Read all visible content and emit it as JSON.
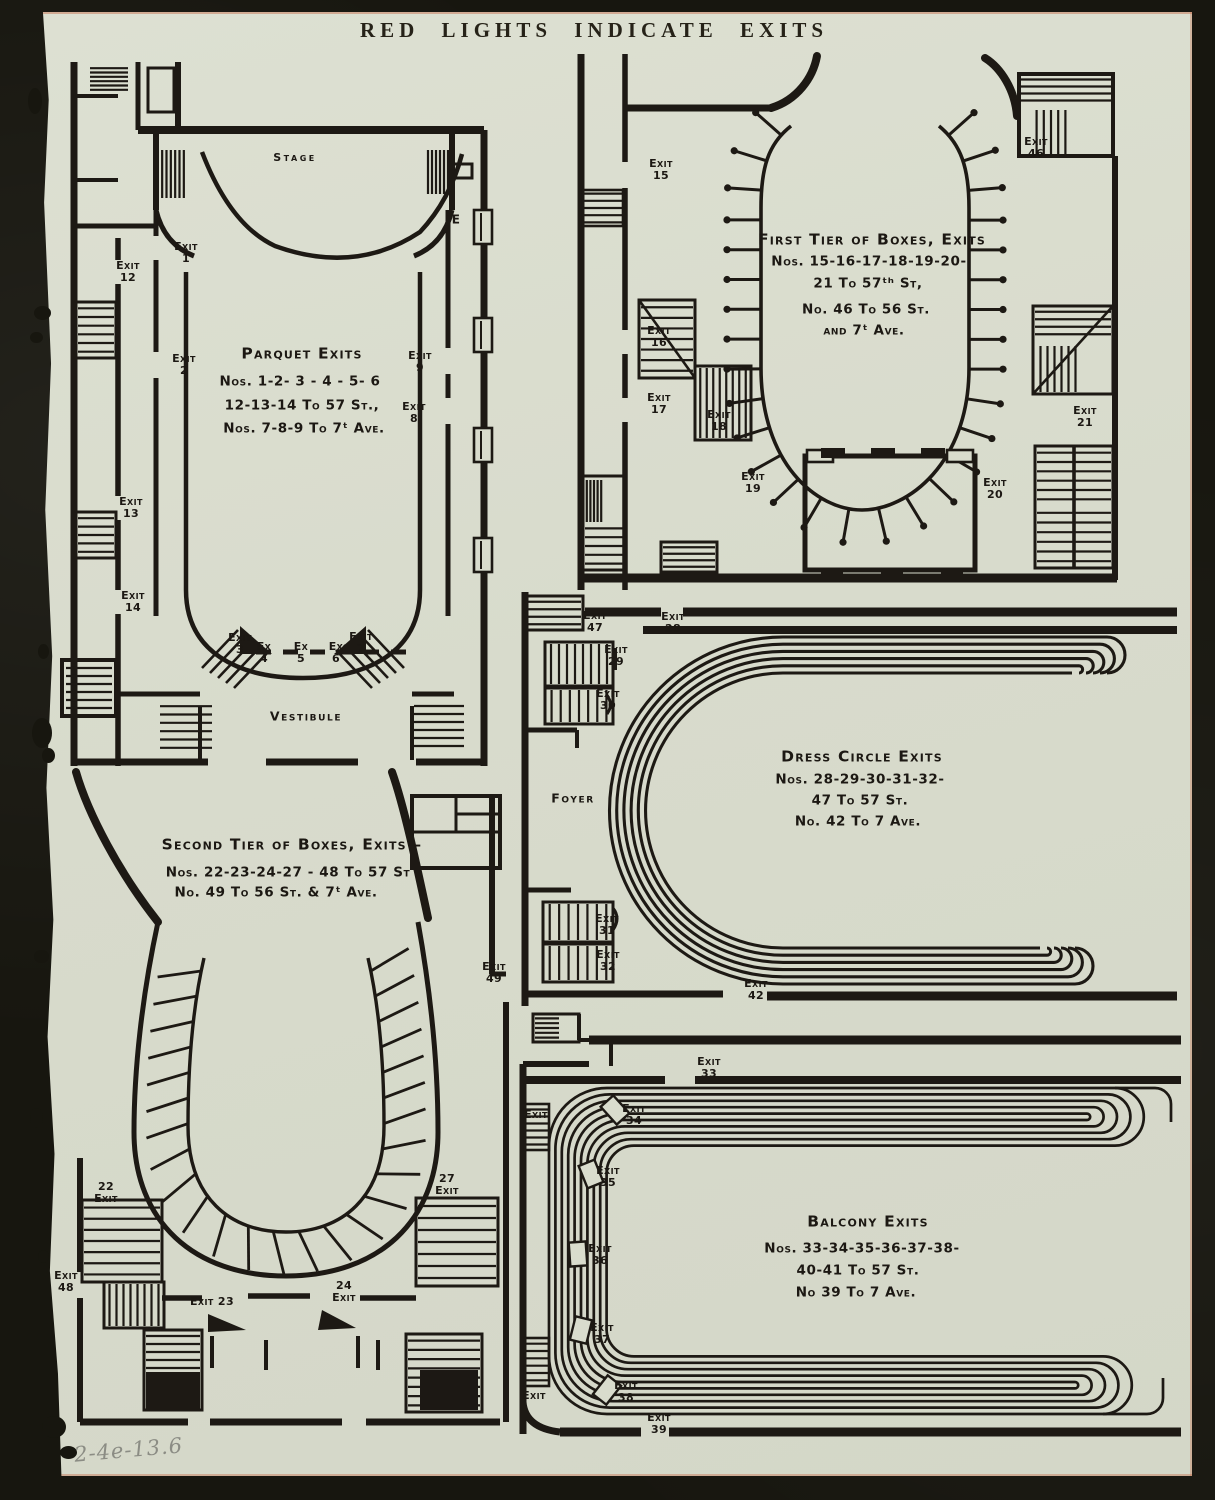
{
  "page": {
    "header": "RED LIGHTS INDICATE EXITS",
    "handwritten_note": "2-4e-13.6",
    "paper_color": "#d9dccd",
    "ink_color": "#1d1914",
    "backdrop_color": "#17160f"
  },
  "plans": {
    "parquet": {
      "stage_label": "Stage",
      "vestibule_label": "Vestibule",
      "wall_mark": "E",
      "title": "Parquet Exits",
      "title_lines": [
        "Nos. 1-2- 3 - 4 - 5- 6",
        "12-13-14 To 57 St.,",
        "Nos. 7-8-9  To 7ᵗ Ave."
      ],
      "exits": {
        "e1": "Exit\n1",
        "e2": "Exit\n2",
        "e3": "Exit\n3",
        "e4": "Ex\n4",
        "e5": "Ex\n5",
        "e6": "Ex\n6",
        "e7": "Exit\n7",
        "e8": "Exit\n8",
        "e9": "Exit\n9",
        "e12": "Exit\n12",
        "e13": "Exit\n13",
        "e14": "Exit\n14"
      }
    },
    "first_tier": {
      "title": "First Tier of Boxes, Exits",
      "title_lines": [
        "Nos. 15-16-17-18-19-20-",
        "21 To 57ᵗʰ St,",
        "No.  46 To 56 St.",
        "and 7ᵗ Ave."
      ],
      "exits": {
        "e15": "Exit\n15",
        "e16": "Exit\n16",
        "e17": "Exit\n17",
        "e18": "Exit\n18",
        "e19": "Exit\n19",
        "e20": "Exit\n20",
        "e21": "Exit 21",
        "e46": "Exit\n46"
      }
    },
    "dress_circle": {
      "title": "Dress Circle Exits",
      "title_lines": [
        "Nos. 28-29-30-31-32-",
        "47 To 57 St.",
        "No. 42 To 7 Ave."
      ],
      "foyer_label": "Foyer",
      "exits": {
        "e28": "Exit\n28",
        "e29": "Exit\n29",
        "e30": "Exit\n30",
        "e31": "Exit\n31",
        "e32": "Exit\n32",
        "e42": "Exit\n42",
        "e47": "Exit\n47"
      }
    },
    "second_tier": {
      "title": "Second Tier of Boxes,  Exits –",
      "title_lines": [
        "Nos. 22-23-24-27 -  48 To 57 St",
        "No.   49 To 56 St. & 7ᵗ Ave."
      ],
      "exits": {
        "e22": "22\nExit",
        "e23": "Exit 23",
        "e24": "24\nExit",
        "e27": "27\nExit",
        "e48": "Exit\n48",
        "e49": "Exit\n49"
      }
    },
    "balcony": {
      "title": "Balcony Exits",
      "title_lines": [
        "Nos. 33-34-35-36-37-38-",
        "40-41 To 57 St.",
        "No 39 To 7 Ave."
      ],
      "exits": {
        "e33": "Exit\n33",
        "e34": "Exit\n34",
        "e35": "Exit\n35",
        "e36": "Exit\n36",
        "e37": "Exit\n37",
        "e38": "Exit\n38",
        "e39": "Exit\n39",
        "side_upper": "Exit",
        "side_lower": "Exit"
      }
    }
  }
}
